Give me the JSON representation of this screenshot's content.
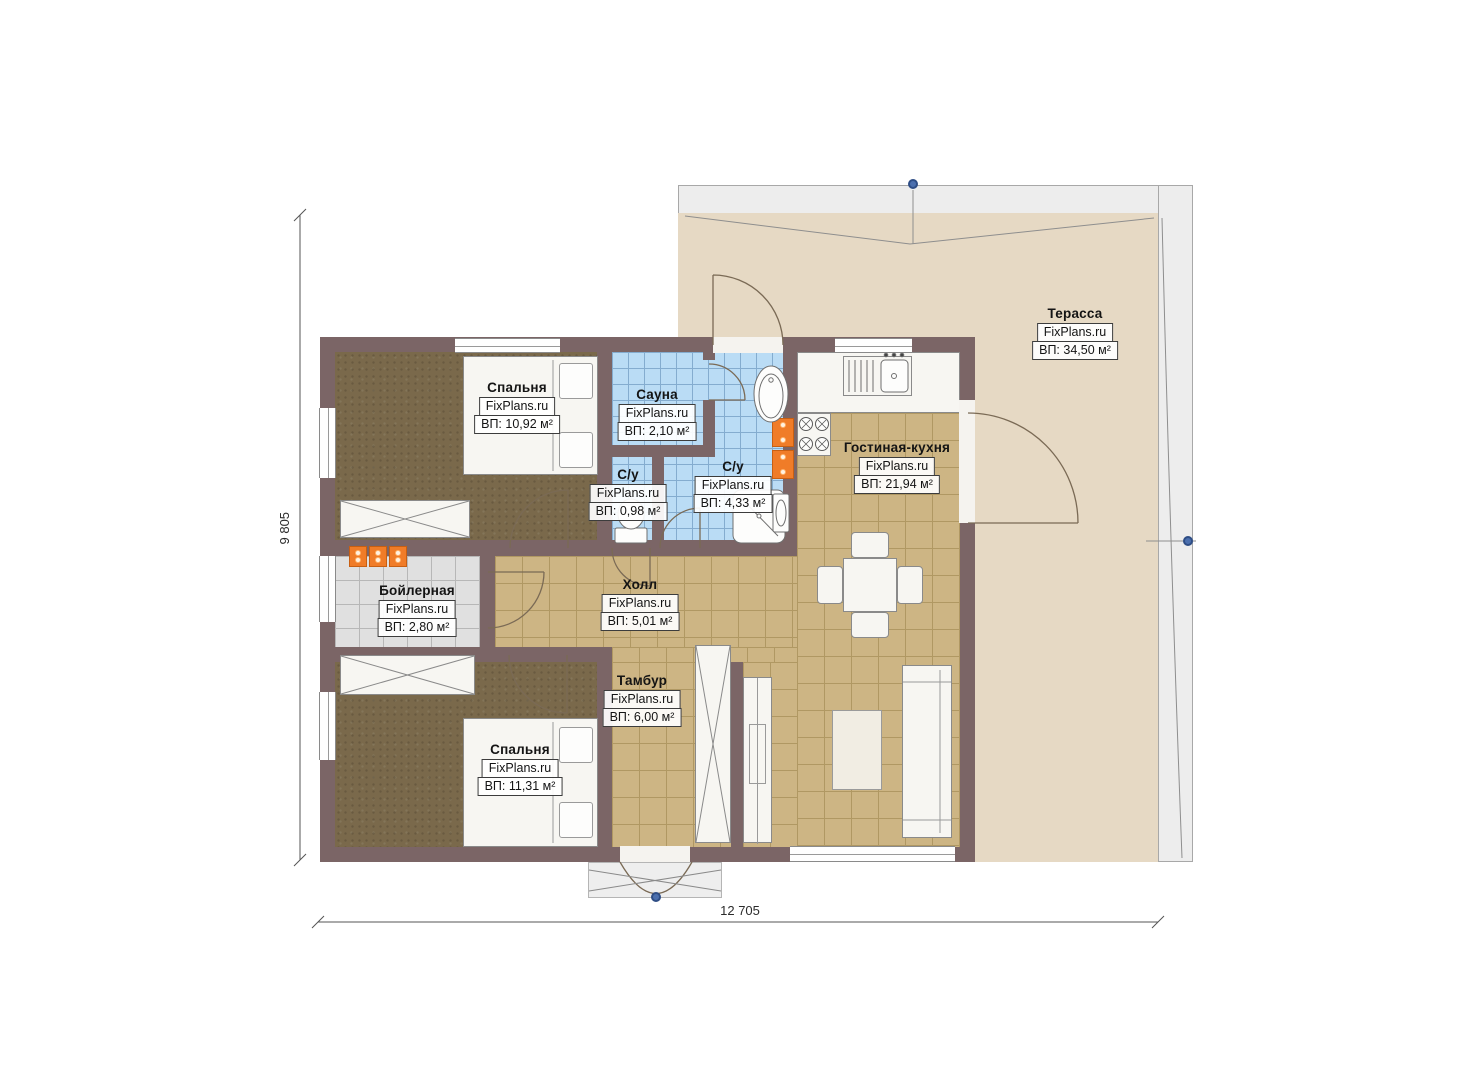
{
  "plan": {
    "watermark": "FixPlans.ru",
    "dimensions": {
      "height_label": "9 805",
      "width_label": "12 705"
    },
    "rooms": [
      {
        "name": "Спальня",
        "area": "ВП: 10,92 м²"
      },
      {
        "name": "Сауна",
        "area": "ВП: 2,10 м²"
      },
      {
        "name": "С/у",
        "area": "ВП: 0,98 м²"
      },
      {
        "name": "С/у",
        "area": "ВП: 4,33 м²"
      },
      {
        "name": "Гостиная-кухня",
        "area": "ВП: 21,94 м²"
      },
      {
        "name": "Терасса",
        "area": "ВП: 34,50 м²"
      },
      {
        "name": "Бойлерная",
        "area": "ВП: 2,80 м²"
      },
      {
        "name": "Холл",
        "area": "ВП: 5,01 м²"
      },
      {
        "name": "Тамбур",
        "area": "ВП: 6,00 м²"
      },
      {
        "name": "Спальня",
        "area": "ВП: 11,31 м²"
      }
    ],
    "colors": {
      "wall": "#7b6566",
      "wood_floor": "#7a694b",
      "tile_tan": "#cdb584",
      "tile_blue": "#badcf5",
      "tile_gray": "#e0e0e0",
      "terrace": "#e6d9c4",
      "radiator_orange": "#f07c28",
      "marker_blue": "#4b6fae"
    }
  }
}
